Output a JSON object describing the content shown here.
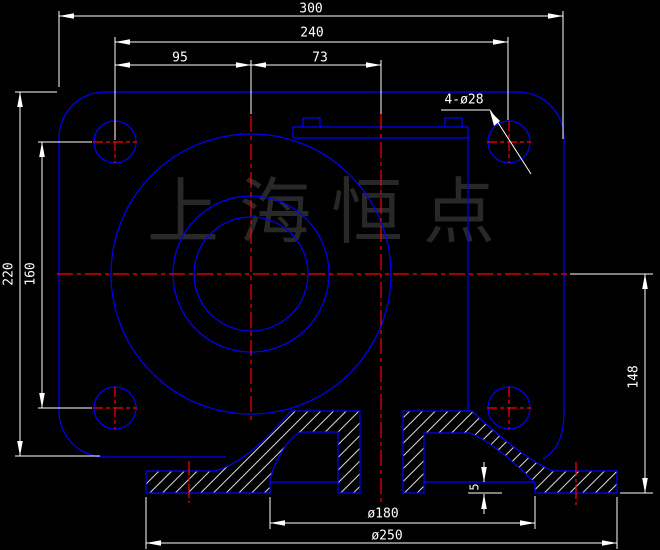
{
  "watermark_text": "上海恒点",
  "labels": {
    "dim_300": "300",
    "dim_240": "240",
    "dim_95": "95",
    "dim_73": "73",
    "hole_callout": "4-ø28",
    "dim_220": "220",
    "dim_160": "160",
    "dim_148": "148",
    "dim_5": "5",
    "dia_180": "ø180",
    "dia_250": "ø250"
  },
  "colors": {
    "background": "#000000",
    "geometry_line": "#0000ff",
    "centerline": "#ff0000",
    "dimension": "#ffffff",
    "hatch": "#dddddd",
    "watermark": "#282828"
  }
}
